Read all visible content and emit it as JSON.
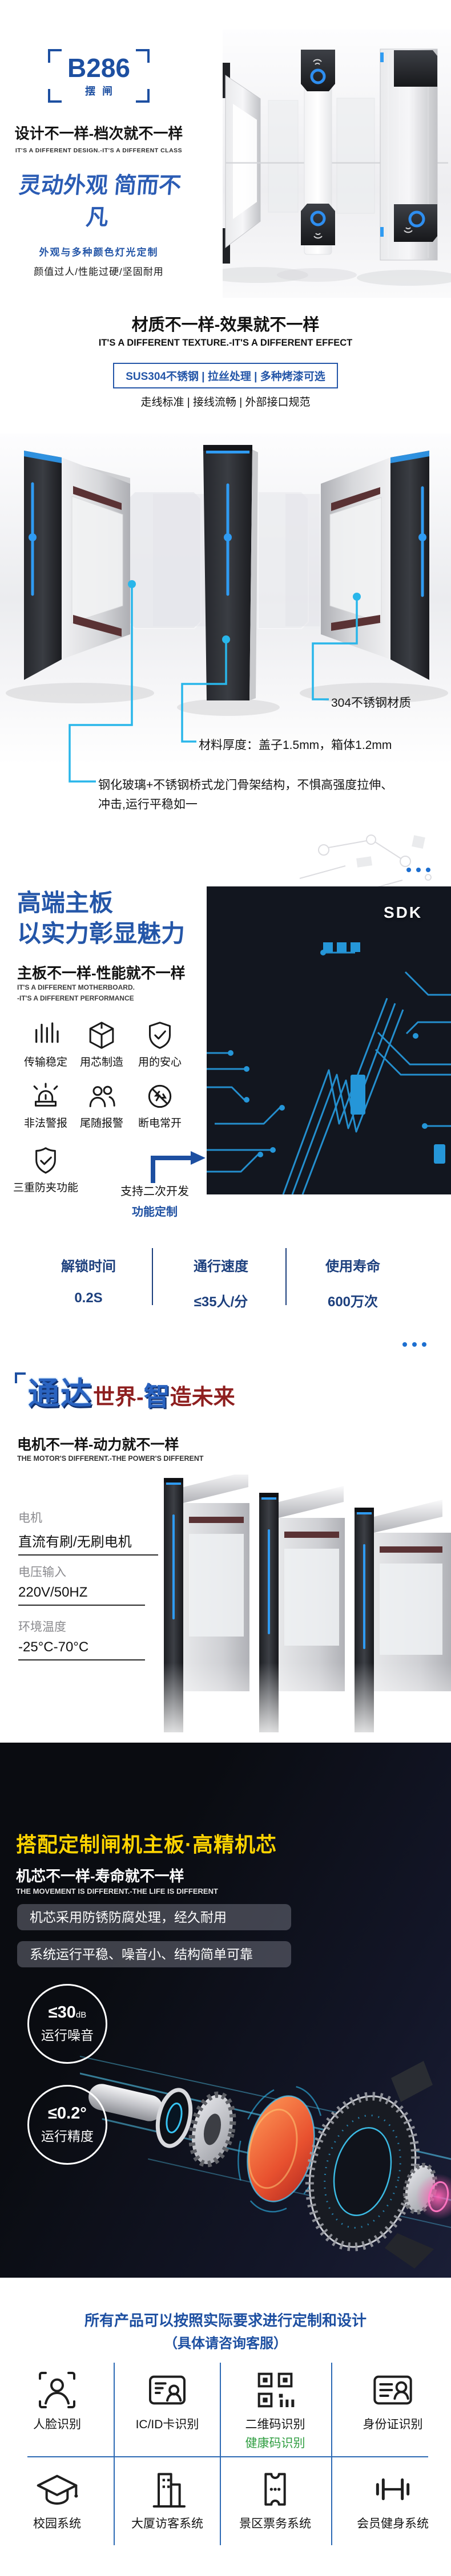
{
  "colors": {
    "accent_blue": "#1d4fa1",
    "heading_blue": "#2456a8",
    "stats_navy": "#1c3f7d",
    "callout_cyan": "#29b6ea",
    "led_blue": "#2f9bf2",
    "highlight_yellow": "#ffd400",
    "brand_dark_red": "#8e1f1f",
    "health_green": "#2f9e41",
    "grid_blue": "#2d6ab4"
  },
  "hero": {
    "model": "B286",
    "model_sub": "摆闸",
    "title": "设计不一样-档次就不一样",
    "title_en": "IT'S A DIFFERENT DESIGN.-IT'S A DIFFERENT CLASS",
    "slogan": "灵动外观 简而不凡",
    "feature_highlight": "外观与多种颜色灯光定制",
    "feature_detail": "颜值过人/性能过硬/坚固耐用"
  },
  "texture": {
    "title": "材质不一样-效果就不一样",
    "title_en": "IT'S A DIFFERENT TEXTURE.-IT'S A DIFFERENT EFFECT",
    "badge": "SUS304不锈钢 | 拉丝处理 | 多种烤漆可选",
    "sub": "走线标准 | 接线流畅 | 外部接口规范",
    "callout_material": "304不锈钢材质",
    "callout_thickness": "材料厚度：盖子1.5mm，箱体1.2mm",
    "callout_structure_line1": "钢化玻璃+不锈钢桥式龙门骨架结构，不惧高强度拉伸、",
    "callout_structure_line2": "冲击,运行平稳如一"
  },
  "board": {
    "title_line1": "高端主板",
    "title_line2": "以实力彰显魅力",
    "sub": "主板不一样-性能就不一样",
    "sub_en_line1": "IT'S A DIFFERENT MOTHERBOARD.",
    "sub_en_line2": "-IT'S A DIFFERENT PERFORMANCE",
    "sdk_label": "SDK",
    "features": [
      {
        "label": "传输稳定"
      },
      {
        "label": "用芯制造"
      },
      {
        "label": "用的安心"
      },
      {
        "label": "非法警报"
      },
      {
        "label": "尾随报警"
      },
      {
        "label": "断电常开"
      },
      {
        "label": "三重防夹功能"
      }
    ],
    "dev_line1": "支持二次开发",
    "dev_line2": "功能定制",
    "stats": [
      {
        "label": "解锁时间",
        "value": "0.2S"
      },
      {
        "label": "通行速度",
        "value": "≤35人/分"
      },
      {
        "label": "使用寿命",
        "value": "600万次"
      }
    ]
  },
  "brand": {
    "part1": "通达",
    "part2": "世界-",
    "part3": "智",
    "part4": "造未来"
  },
  "motor": {
    "title": "电机不一样-动力就不一样",
    "title_en": "THE MOTOR'S DIFFERENT.-THE POWER'S DIFFERENT",
    "specs": [
      {
        "label": "电机",
        "value": "直流有刷/无刷电机"
      },
      {
        "label": "电压输入",
        "value": "220V/50HZ"
      },
      {
        "label": "环境温度",
        "value": "-25°C-70°C"
      }
    ]
  },
  "movement": {
    "title": "搭配定制闸机主板·高精机芯",
    "sub": "机芯不一样-寿命就不一样",
    "sub_en": "THE MOVEMENT IS DIFFERENT.-THE LIFE IS DIFFERENT",
    "pill1": "机芯采用防锈防腐处理，经久耐用",
    "pill2": "系统运行平稳、噪音小、结构简单可靠",
    "badge1": {
      "value": "≤30",
      "unit": "dB",
      "label": "运行噪音"
    },
    "badge2": {
      "value": "≤0.2°",
      "label": "运行精度"
    }
  },
  "footer": {
    "note1": "所有产品可以按照实际要求进行定制和设计",
    "note2": "（具体请咨询客服）",
    "services_row1": [
      {
        "label": "人脸识别"
      },
      {
        "label": "IC/ID卡识别"
      },
      {
        "label": "二维码识别",
        "sub": "健康码识别"
      },
      {
        "label": "身份证识别"
      }
    ],
    "services_row2": [
      {
        "label": "校园系统"
      },
      {
        "label": "大厦访客系统"
      },
      {
        "label": "景区票务系统"
      },
      {
        "label": "会员健身系统"
      }
    ]
  }
}
